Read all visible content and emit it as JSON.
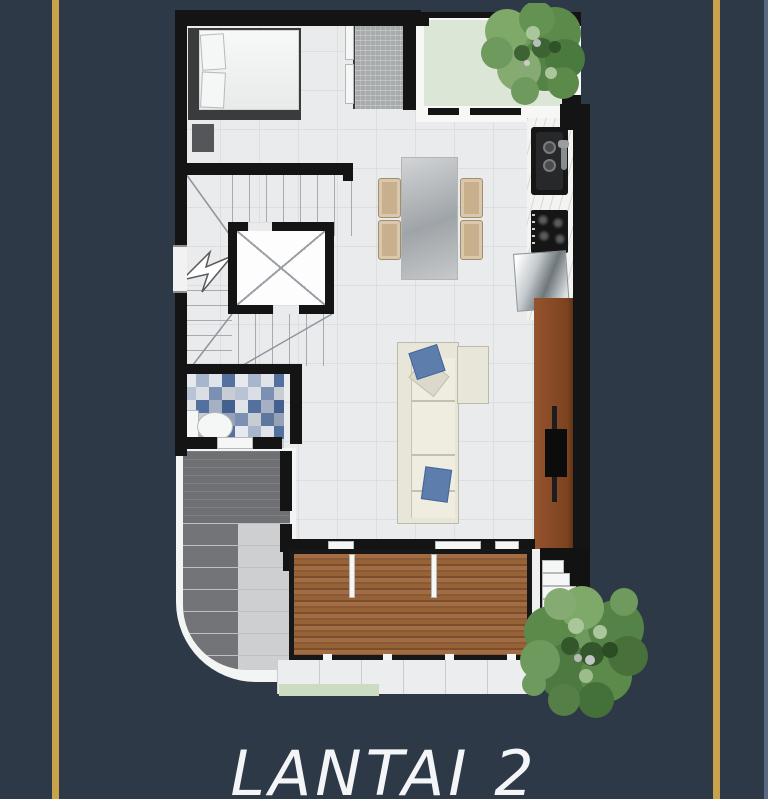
{
  "page": {
    "background_color": "#2e3947",
    "accent_line_color": "#c8a24c",
    "edge_strip_color": "#5a6780"
  },
  "caption": {
    "title": "LANTAI 2",
    "color": "#f4f5f6"
  },
  "floor_plan": {
    "type": "residential-floor-plan",
    "floor_color": "#e9ebed",
    "wall_color": "#141414",
    "balcony_color": "#dce6d6",
    "deck_color": "#96633a",
    "tv_cabinet_color": "#8a4c2c",
    "mosaic_colors": [
      "#54709e",
      "#c8cdd4",
      "#7b90b2",
      "#e0e3e7"
    ],
    "tree_colors": [
      "#6f9a5e",
      "#5c8a4b",
      "#49703a",
      "#86ab72"
    ],
    "elements": [
      "bed",
      "nightstand",
      "wardrobe",
      "planted-balcony",
      "tree",
      "kitchen-sink",
      "stove",
      "refrigerator",
      "dining-table",
      "dining-chairs",
      "staircase",
      "void-shaft",
      "break-line",
      "bathroom",
      "toilet",
      "sofa",
      "tv",
      "tv-cabinet",
      "wood-deck",
      "roof",
      "walkway",
      "exterior-steps"
    ]
  }
}
